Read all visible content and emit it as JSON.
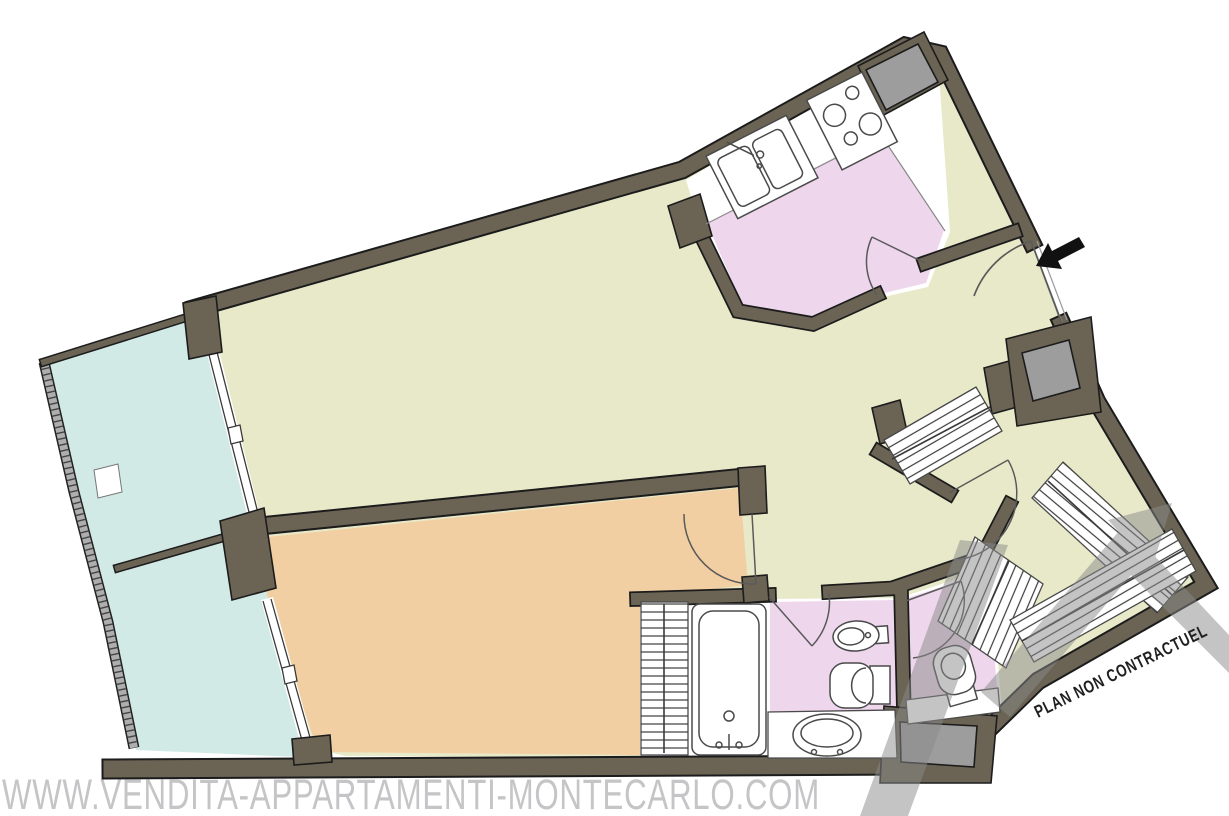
{
  "page": {
    "type": "apartment-floor-plan"
  },
  "texts": {
    "plan_disclaimer": "PLAN NON CONTRACTUEL",
    "watermark_url": "WWW.VENDITA-APPARTAMENTI-MONTECARLO.COM"
  },
  "colors": {
    "wall": "#6b6455",
    "wall_outline": "#1c1c1c",
    "living_room": "#e8e9c8",
    "kitchen": "#eed6ec",
    "bedroom": "#f2cfa2",
    "terrace": "#d2eae6",
    "bathroom": "#eed6ec",
    "wc": "#eed6ec",
    "shaft": "#9d9d9d",
    "fixture_fill": "#ffffff",
    "fixture_stroke": "#4a4a4a",
    "entry_arrow": "#111111",
    "watermark_text": "#c5c5c7",
    "watermark_logo": "#8a8a8a",
    "railing": "#aeaeae"
  },
  "rooms": [
    {
      "name": "terrace"
    },
    {
      "name": "living-room"
    },
    {
      "name": "kitchen"
    },
    {
      "name": "bedroom"
    },
    {
      "name": "bathroom"
    },
    {
      "name": "wc"
    },
    {
      "name": "entry-hall"
    },
    {
      "name": "dressing"
    }
  ],
  "fixtures": [
    "kitchen-double-sink",
    "stove-4-burners",
    "utility-shaft",
    "entry-door",
    "bathtub",
    "washbasin",
    "bidet",
    "toilet",
    "wc-toilet",
    "wardrobe-closets",
    "terrace-windows",
    "terrace-railing"
  ]
}
